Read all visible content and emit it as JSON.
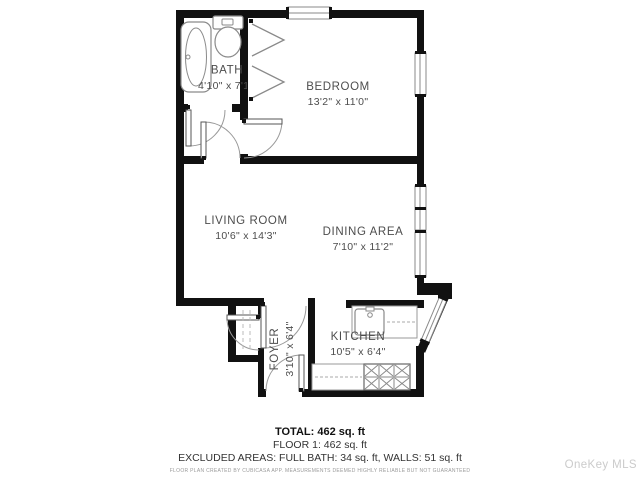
{
  "rooms": {
    "bath": {
      "name": "BATH",
      "dims": "4'10\" x 7'1\""
    },
    "bedroom": {
      "name": "BEDROOM",
      "dims": "13'2\" x 11'0\""
    },
    "living": {
      "name": "LIVING ROOM",
      "dims": "10'6\" x 14'3\""
    },
    "dining": {
      "name": "DINING AREA",
      "dims": "7'10\" x 11'2\""
    },
    "kitchen": {
      "name": "KITCHEN",
      "dims": "10'5\" x 6'4\""
    },
    "foyer": {
      "name": "FOYER",
      "dims": "3'10\" x 6'4\""
    }
  },
  "summary": {
    "total": "TOTAL: 462 sq. ft",
    "floor": "FLOOR 1: 462 sq. ft",
    "excluded": "EXCLUDED AREAS: FULL BATH: 34 sq. ft, WALLS: 51 sq. ft",
    "disclaimer": "FLOOR PLAN CREATED BY CUBICASA APP. MEASUREMENTS DEEMED HIGHLY RELIABLE BUT NOT GUARANTEED"
  },
  "watermark": "OneKey MLS",
  "colors": {
    "wall": "#111111",
    "fixture": "#8a8a8a",
    "room_text": "#4d4d4d",
    "watermark_text": "#cbcbcb"
  }
}
